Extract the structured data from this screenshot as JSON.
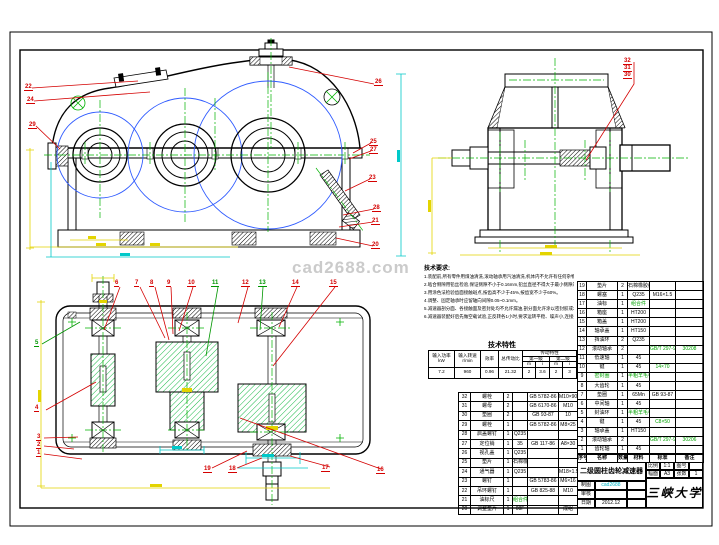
{
  "watermark": "cad2688.com",
  "callouts": {
    "front": [
      "22",
      "24",
      "29",
      "26",
      "25",
      "27",
      "23",
      "28",
      "21",
      "20"
    ],
    "side": [
      "32",
      "31",
      "30"
    ],
    "plan": [
      "6",
      "7",
      "8",
      "9",
      "10",
      "11",
      "12",
      "13",
      "14",
      "15",
      "5",
      "4",
      "3",
      "2",
      "1",
      "19",
      "18",
      "17",
      "16"
    ]
  },
  "notes": {
    "heading": "技术要求:",
    "lines": [
      "1.装配前,所有零件用煤油清洗,滚动轴承用汽油清洗,机体内不允许有任何杂物存在,箱体内壁涂耐油油漆。",
      "2.啮合侧隙用铅丝检验,保证侧隙不小于0.16mm,铅丝直径不得大于最小侧隙的4倍。",
      "3.用涂色法检验齿面接触斑点,按齿高不少于45%,按齿宽不少于60%。",
      "4.调整、固定轴承时应留轴向间隙0.05~0.1mm。",
      "5.减速器剖分面、各接触面及密封处均不允许漏油,剖分面允许涂以密封胶或水玻璃,不允许使用任何填料。",
      "6.减速器装配好后先做空载试验,正反转各1小时,要求运转平稳、噪声小,连接处不松动。"
    ]
  },
  "tech": {
    "title": "技术特性",
    "h_power": "输入功率",
    "u_power": "kW",
    "h_speed": "输入转速",
    "u_speed": "r/min",
    "h_eff": "效率",
    "h_ratio": "总传动比",
    "h_trans": "传动特性",
    "h_s1": "第一级",
    "h_s2": "第二级",
    "h_m": "m",
    "h_i": "i",
    "v_power": "7.2",
    "v_speed": "960",
    "v_eff": "0.96",
    "v_ratio": "21.32",
    "v_m1": "2",
    "v_i1": "3.6",
    "v_m2": "2",
    "v_i2": "3"
  },
  "bom_header": [
    "序号",
    "名称",
    "数量",
    "材料",
    "标准",
    "备注"
  ],
  "bom_right": {
    "rows": [
      {
        "no": "19",
        "name": "垫片",
        "qty": "2",
        "mat": "石棉橡胶纸",
        "std": "",
        "note": ""
      },
      {
        "no": "18",
        "name": "螺塞",
        "qty": "1",
        "mat": "Q235",
        "std": "M16×1.5",
        "note": ""
      },
      {
        "no": "17",
        "name": "油标",
        "qty": "1",
        "mat": "组合件",
        "std": "",
        "note": "",
        "matc": "g"
      },
      {
        "no": "16",
        "name": "箱座",
        "qty": "1",
        "mat": "HT200",
        "std": "",
        "note": ""
      },
      {
        "no": "15",
        "name": "箱盖",
        "qty": "1",
        "mat": "HT200",
        "std": "",
        "note": ""
      },
      {
        "no": "14",
        "name": "轴承盖",
        "qty": "1",
        "mat": "HT150",
        "std": "",
        "note": ""
      },
      {
        "no": "13",
        "name": "挡油环",
        "qty": "2",
        "mat": "Q235",
        "std": "",
        "note": ""
      },
      {
        "no": "12",
        "name": "滚动轴承",
        "qty": "2",
        "mat": "",
        "std": "GB/T 297-94",
        "note": "30208",
        "stdc": "g",
        "notec": "g"
      },
      {
        "no": "11",
        "name": "低速轴",
        "qty": "1",
        "mat": "45",
        "std": "",
        "note": ""
      },
      {
        "no": "10",
        "name": "键",
        "qty": "1",
        "mat": "45",
        "std": "14×70",
        "note": "",
        "stdc": "g"
      },
      {
        "no": "9",
        "name": "密封圈",
        "qty": "1",
        "mat": "半粗羊毛毡",
        "std": "",
        "note": "",
        "namec": "g",
        "matc": "g"
      },
      {
        "no": "8",
        "name": "大齿轮",
        "qty": "1",
        "mat": "45",
        "std": "",
        "note": ""
      },
      {
        "no": "7",
        "name": "垫圈",
        "qty": "1",
        "mat": "65Mn",
        "std": "GB 93-87",
        "note": ""
      },
      {
        "no": "6",
        "name": "中间轴",
        "qty": "1",
        "mat": "45",
        "std": "",
        "note": ""
      },
      {
        "no": "5",
        "name": "封油环",
        "qty": "1",
        "mat": "半粗羊毛毡",
        "std": "",
        "note": "",
        "matc": "g"
      },
      {
        "no": "4",
        "name": "键",
        "qty": "1",
        "mat": "45",
        "std": "C8×50",
        "note": "",
        "stdc": "g"
      },
      {
        "no": "3",
        "name": "轴承盖",
        "qty": "1",
        "mat": "HT150",
        "std": "",
        "note": ""
      },
      {
        "no": "2",
        "name": "滚动轴承",
        "qty": "2",
        "mat": "",
        "std": "GB/T 297-94",
        "note": "30206",
        "stdc": "g",
        "notec": "g"
      },
      {
        "no": "1",
        "name": "齿轮轴",
        "qty": "1",
        "mat": "45",
        "std": "",
        "note": ""
      }
    ]
  },
  "bom_left": {
    "rows": [
      {
        "no": "32",
        "name": "螺栓",
        "qty": "2",
        "mat": "",
        "std": "GB 5782-86",
        "note": "M10×90"
      },
      {
        "no": "31",
        "name": "螺母",
        "qty": "2",
        "mat": "",
        "std": "GB 6170-86",
        "note": "M10"
      },
      {
        "no": "30",
        "name": "垫圈",
        "qty": "2",
        "mat": "",
        "std": "GB 93-87",
        "note": "10"
      },
      {
        "no": "29",
        "name": "螺栓",
        "qty": "1",
        "mat": "",
        "std": "GB 5782-86",
        "note": "M8×25"
      },
      {
        "no": "28",
        "name": "启盖螺钉",
        "qty": "1",
        "mat": "Q235",
        "std": "",
        "note": ""
      },
      {
        "no": "27",
        "name": "定位销",
        "qty": "1",
        "mat": "35",
        "std": "GB 117-86",
        "note": "A8×30"
      },
      {
        "no": "26",
        "name": "视孔盖",
        "qty": "1",
        "mat": "Q235",
        "std": "",
        "note": ""
      },
      {
        "no": "25",
        "name": "垫片",
        "qty": "1",
        "mat": "石棉橡胶纸",
        "std": "",
        "note": ""
      },
      {
        "no": "24",
        "name": "通气器",
        "qty": "1",
        "mat": "Q235",
        "std": "",
        "note": "M18×1.5"
      },
      {
        "no": "23",
        "name": "螺钉",
        "qty": "1",
        "mat": "",
        "std": "GB 5783-86",
        "note": "M6×16"
      },
      {
        "no": "22",
        "name": "吊环螺钉",
        "qty": "1",
        "mat": "",
        "std": "GB 825-88",
        "note": "M10"
      },
      {
        "no": "21",
        "name": "油标尺",
        "qty": "1",
        "mat": "组合件",
        "std": "",
        "note": "",
        "matc": "g"
      },
      {
        "no": "20",
        "name": "调整垫片",
        "qty": "1",
        "mat": "08F",
        "std": "",
        "note": "成组"
      }
    ]
  },
  "title_block": {
    "title": "二级圆柱齿轮减速器",
    "scale_label": "比例",
    "scale": "1:1",
    "dwg_label": "图号",
    "dwg": "",
    "size_label": "幅面",
    "size": "A3",
    "sheet_label": "张数",
    "sheet": "1",
    "drawn_label": "制图",
    "drawn": "cad2688",
    "check_label": "审核",
    "check": "",
    "date_label": "日期",
    "date": "2012.12",
    "school": "三峡大学"
  }
}
